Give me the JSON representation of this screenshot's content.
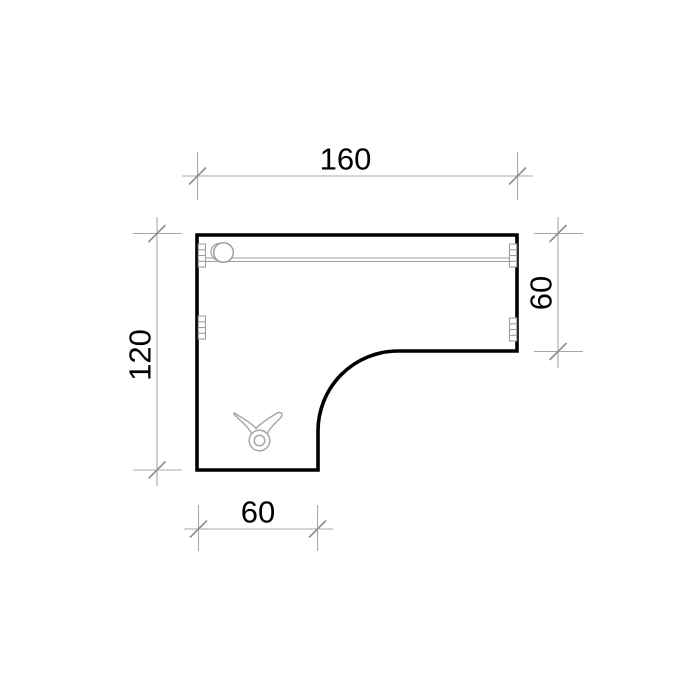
{
  "drawing": {
    "title": "L-shaped desk top plan view",
    "dimensions": {
      "top_width": {
        "label": "160"
      },
      "right_depth": {
        "label": "60"
      },
      "left_height": {
        "label": "120"
      },
      "bottom_width": {
        "label": "60"
      }
    },
    "icons": {
      "grommet": "cable-grommet-icon",
      "clip": "cable-clip-icon",
      "fittings": "edge-fitting-icon",
      "ticks": "dimension-tick-icon"
    },
    "colors": {
      "outline": "#000000",
      "dimension_lines": "#a8a8a8",
      "tick_marks": "#8f8f8f",
      "detail_lines": "#9e9e9e",
      "text": "#000000",
      "background": "#ffffff"
    }
  }
}
